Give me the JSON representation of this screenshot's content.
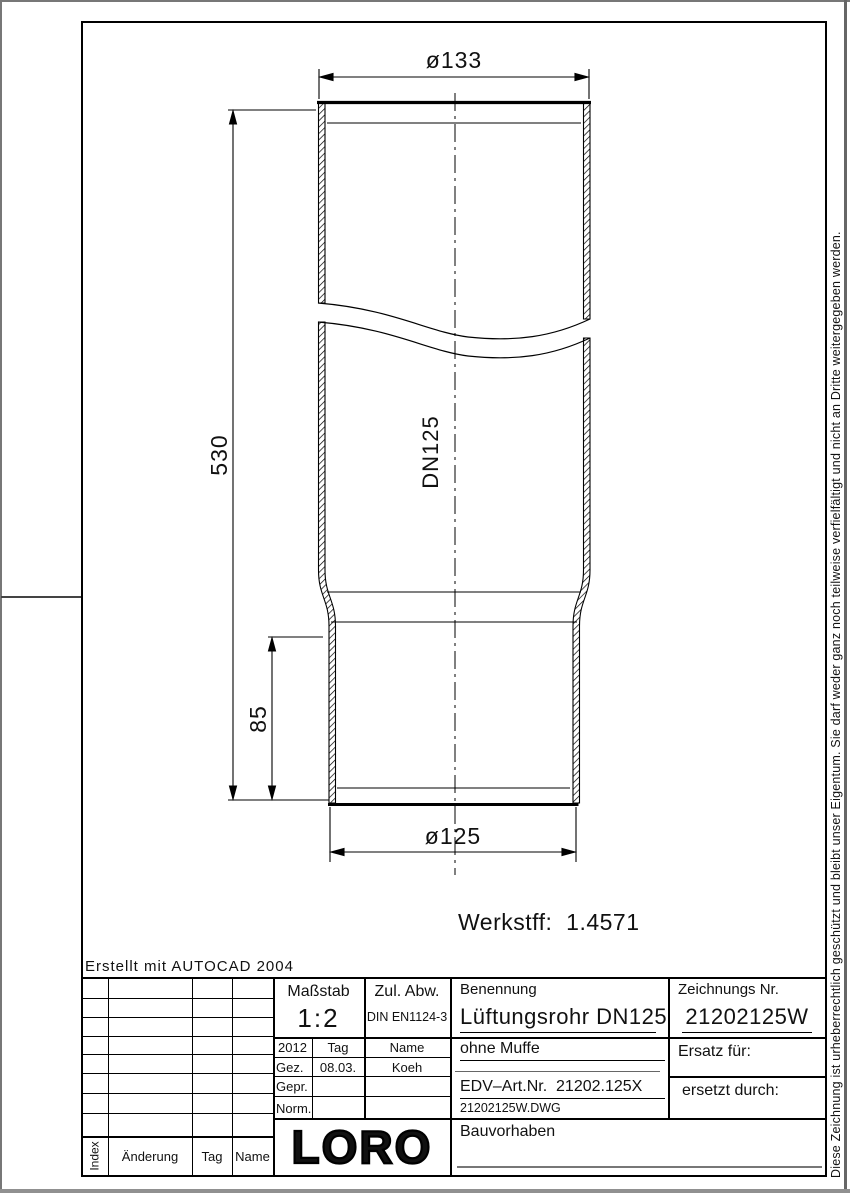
{
  "frame": {
    "autocad_note": "Erstellt mit AUTOCAD 2004",
    "copyright": "Diese Zeichnung ist urheberrechtlich geschützt und bleibt unser Eigentum. Sie darf weder ganz noch teilweise verfielfältigt und nicht an Dritte weitergegeben werden."
  },
  "drawing": {
    "dim_top_diameter": "ø133",
    "dim_total_height": "530",
    "dim_spigot_height": "85",
    "dim_bottom_diameter": "ø125",
    "pipe_label": "DN125",
    "material_note": "Werkstff:  1.4571"
  },
  "title_block": {
    "scale_label": "Maßstab",
    "scale_value": "1:2",
    "tolerance_label": "Zul. Abw.",
    "tolerance_value": "DIN EN1124-3",
    "year": "2012",
    "col_day": "Tag",
    "col_name": "Name",
    "row_drawn_label": "Gez.",
    "row_drawn_day": "08.03.",
    "row_drawn_name": "Koeh",
    "row_checked_label": "Gepr.",
    "row_standard_label": "Norm.",
    "name_label": "Benennung",
    "name_value": "Lüftungsrohr DN125",
    "name_sub": "ohne Muffe",
    "edv_art_nr": "EDV–Art.Nr.  21202.125X",
    "file_name": "21202125W.DWG",
    "drawing_no_label": "Zeichnungs Nr.",
    "drawing_no_value": "21202125W",
    "replacement_for": "Ersatz für:",
    "replaced_by": "ersetzt durch:",
    "project_label": "Bauvorhaben",
    "logo": "LORO",
    "rev_header_index": "Index",
    "rev_header_change": "Änderung",
    "rev_header_day": "Tag",
    "rev_header_name": "Name"
  }
}
